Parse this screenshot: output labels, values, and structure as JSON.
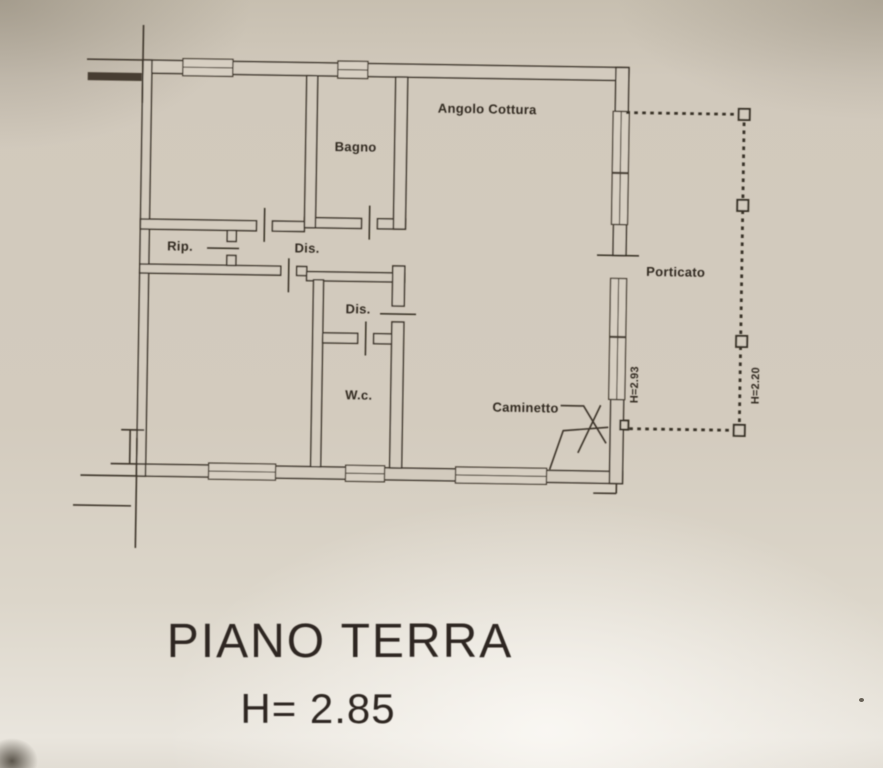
{
  "colors": {
    "paper": "#d3cbbe",
    "ink": "#3e362b",
    "label_text": "#322b21"
  },
  "floor_plan": {
    "room_labels": {
      "bagno": "Bagno",
      "angolo_cottura": "Angolo Cottura",
      "rip": "Rip.",
      "dis_top": "Dis.",
      "dis_lower": "Dis.",
      "wc": "W.c.",
      "caminetto": "Caminetto",
      "porticato": "Porticato"
    },
    "height_annotations": {
      "right_wall": "H=2.93",
      "porticato": "H=2.20"
    }
  },
  "caption": {
    "title": "PIANO TERRA",
    "height": "H= 2.85"
  }
}
